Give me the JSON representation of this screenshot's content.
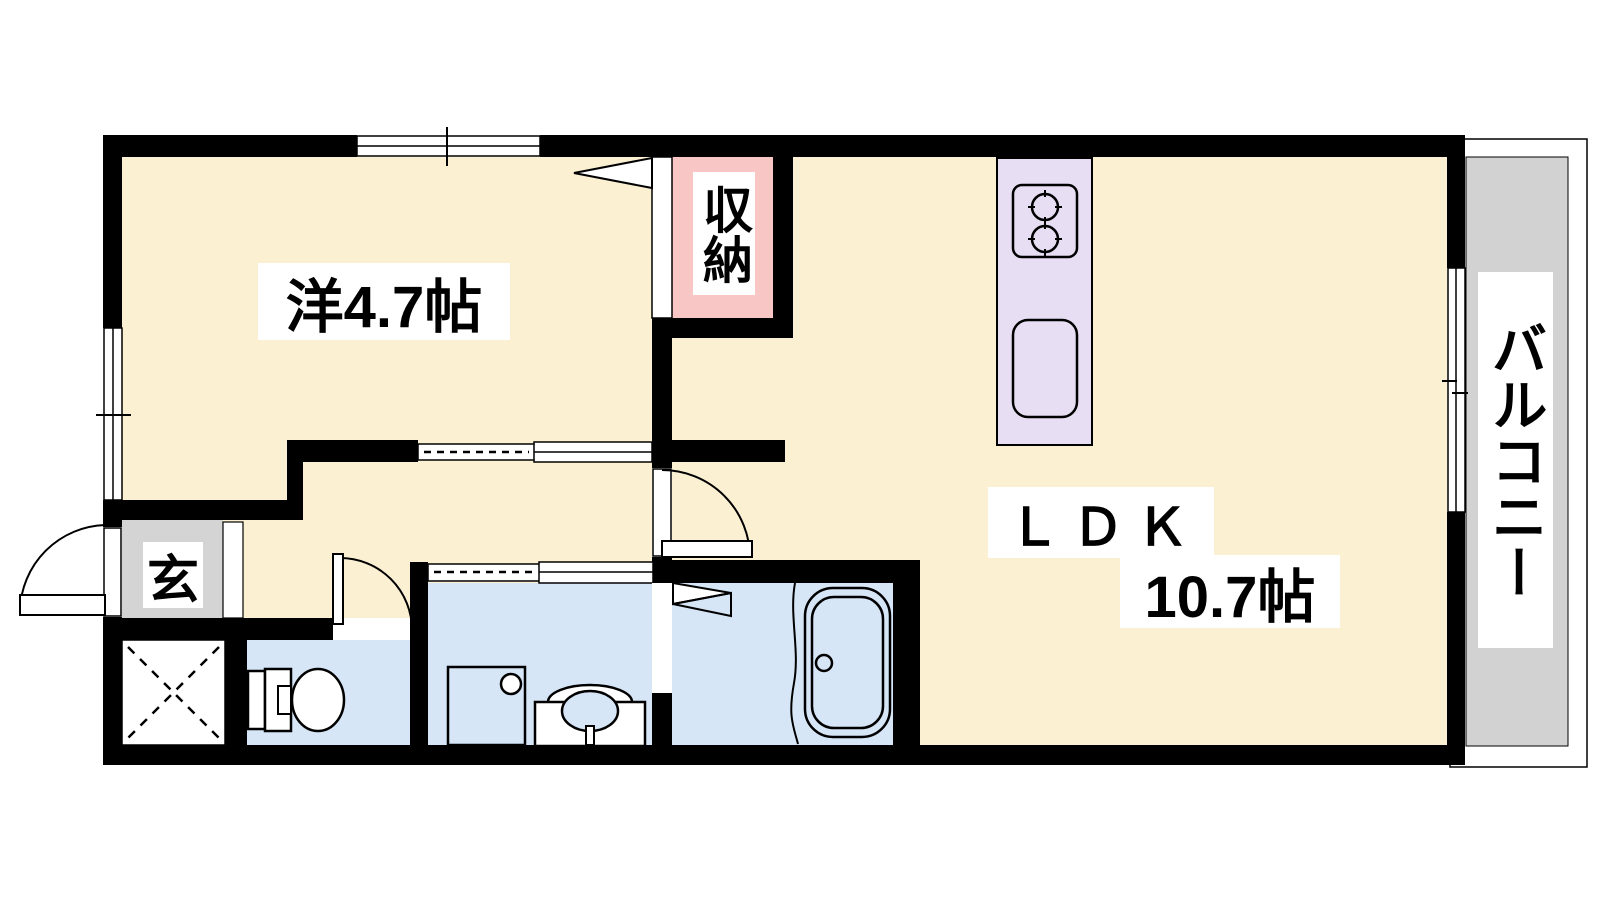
{
  "plan": {
    "type": "apartment-floorplan",
    "rooms": {
      "western": {
        "label": "洋4.7帖"
      },
      "ldk": {
        "label": "ＬＤＫ",
        "size_label": "10.7帖"
      },
      "closet": {
        "label": "収納"
      },
      "entrance": {
        "label": "玄"
      },
      "balcony": {
        "label": "バルコニー"
      }
    },
    "fixtures": [
      "kitchen-stove",
      "kitchen-sink",
      "toilet",
      "washer-pan",
      "vanity-basin",
      "bathtub"
    ],
    "colors": {
      "floor": "#fcf0d3",
      "closet": "#f9c6c6",
      "kitchen_counter": "#e7def3",
      "wet_area": "#d6e6f7",
      "entrance_floor": "#d4d4d4",
      "balcony_floor": "#d2d2d2",
      "wall": "#000000",
      "label_bg": "#ffffff"
    }
  }
}
